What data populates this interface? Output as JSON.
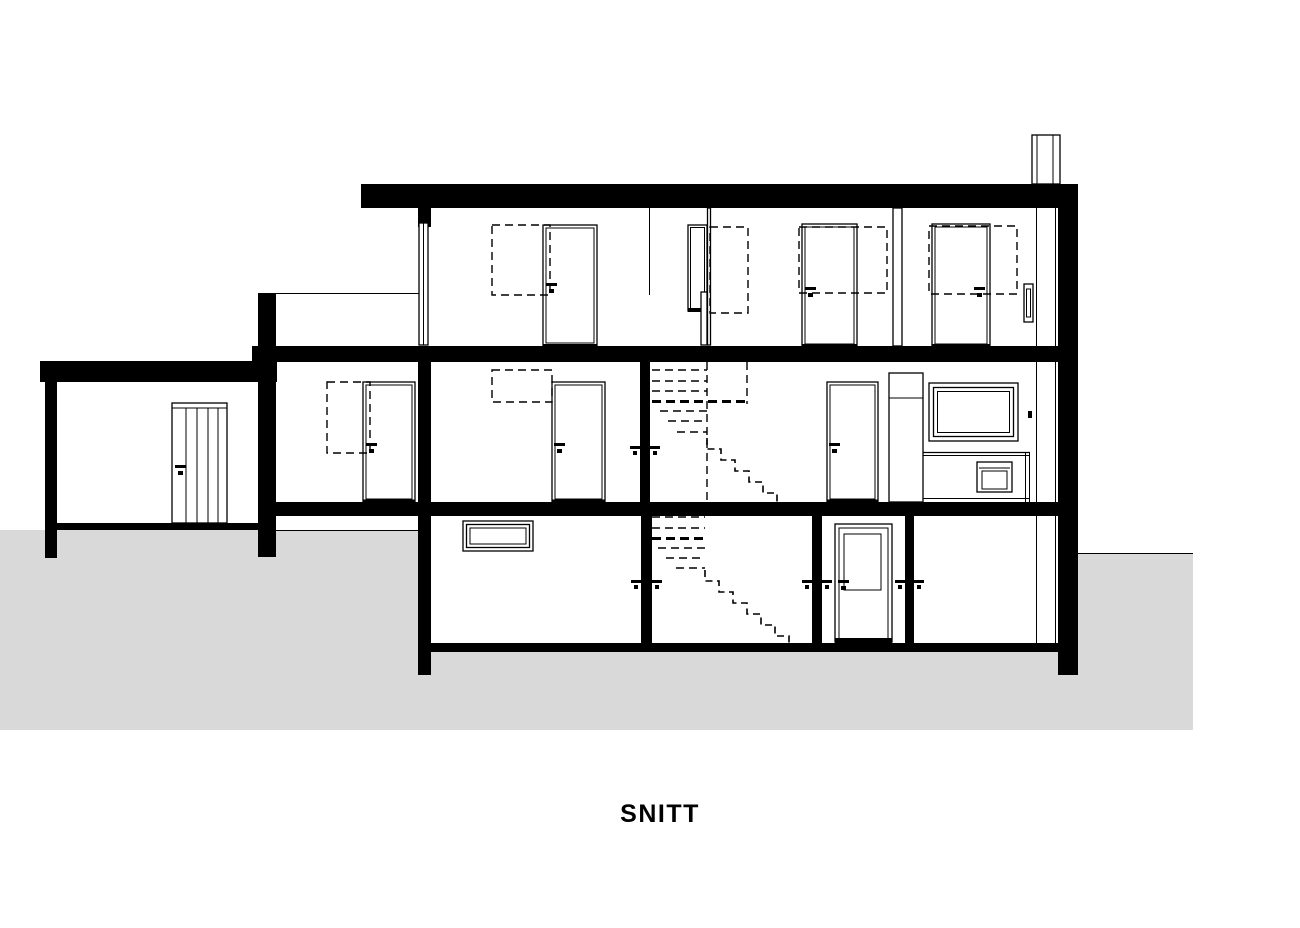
{
  "title": "SNITT",
  "drawing": {
    "type": "building-section",
    "label": "SNITT",
    "palette": {
      "ink": "#000000",
      "paper": "#ffffff",
      "ground": "#d9d9d9"
    },
    "features": {
      "levels": 3,
      "doors": 8,
      "windows": 3,
      "stairs": 2,
      "chimney": 1,
      "carport": 1
    }
  }
}
